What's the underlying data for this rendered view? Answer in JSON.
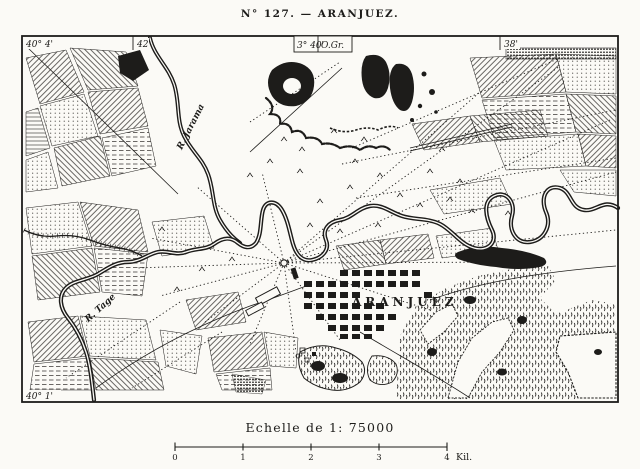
{
  "page": {
    "title": "N° 127. — ARANJUEZ."
  },
  "frame": {
    "lat_top_left": "40° 4'",
    "lat_bottom_left": "40° 1'",
    "lon_left_tick": "42",
    "lon_center_value": "3° 40'",
    "lon_center_ref": "O.Gr.",
    "lon_right_tick": "38'"
  },
  "map": {
    "labels": {
      "river_jarama": "R. Jarama",
      "river_tage": "R. Tage",
      "town": "ARANJUEZ"
    }
  },
  "scale": {
    "caption": "Echelle de 1: 75000",
    "tick_labels": [
      "0",
      "1",
      "2",
      "3",
      "4"
    ],
    "unit_label": "Kil."
  },
  "colors": {
    "ink": "#1d1c1a",
    "paper": "#fbfaf6"
  }
}
